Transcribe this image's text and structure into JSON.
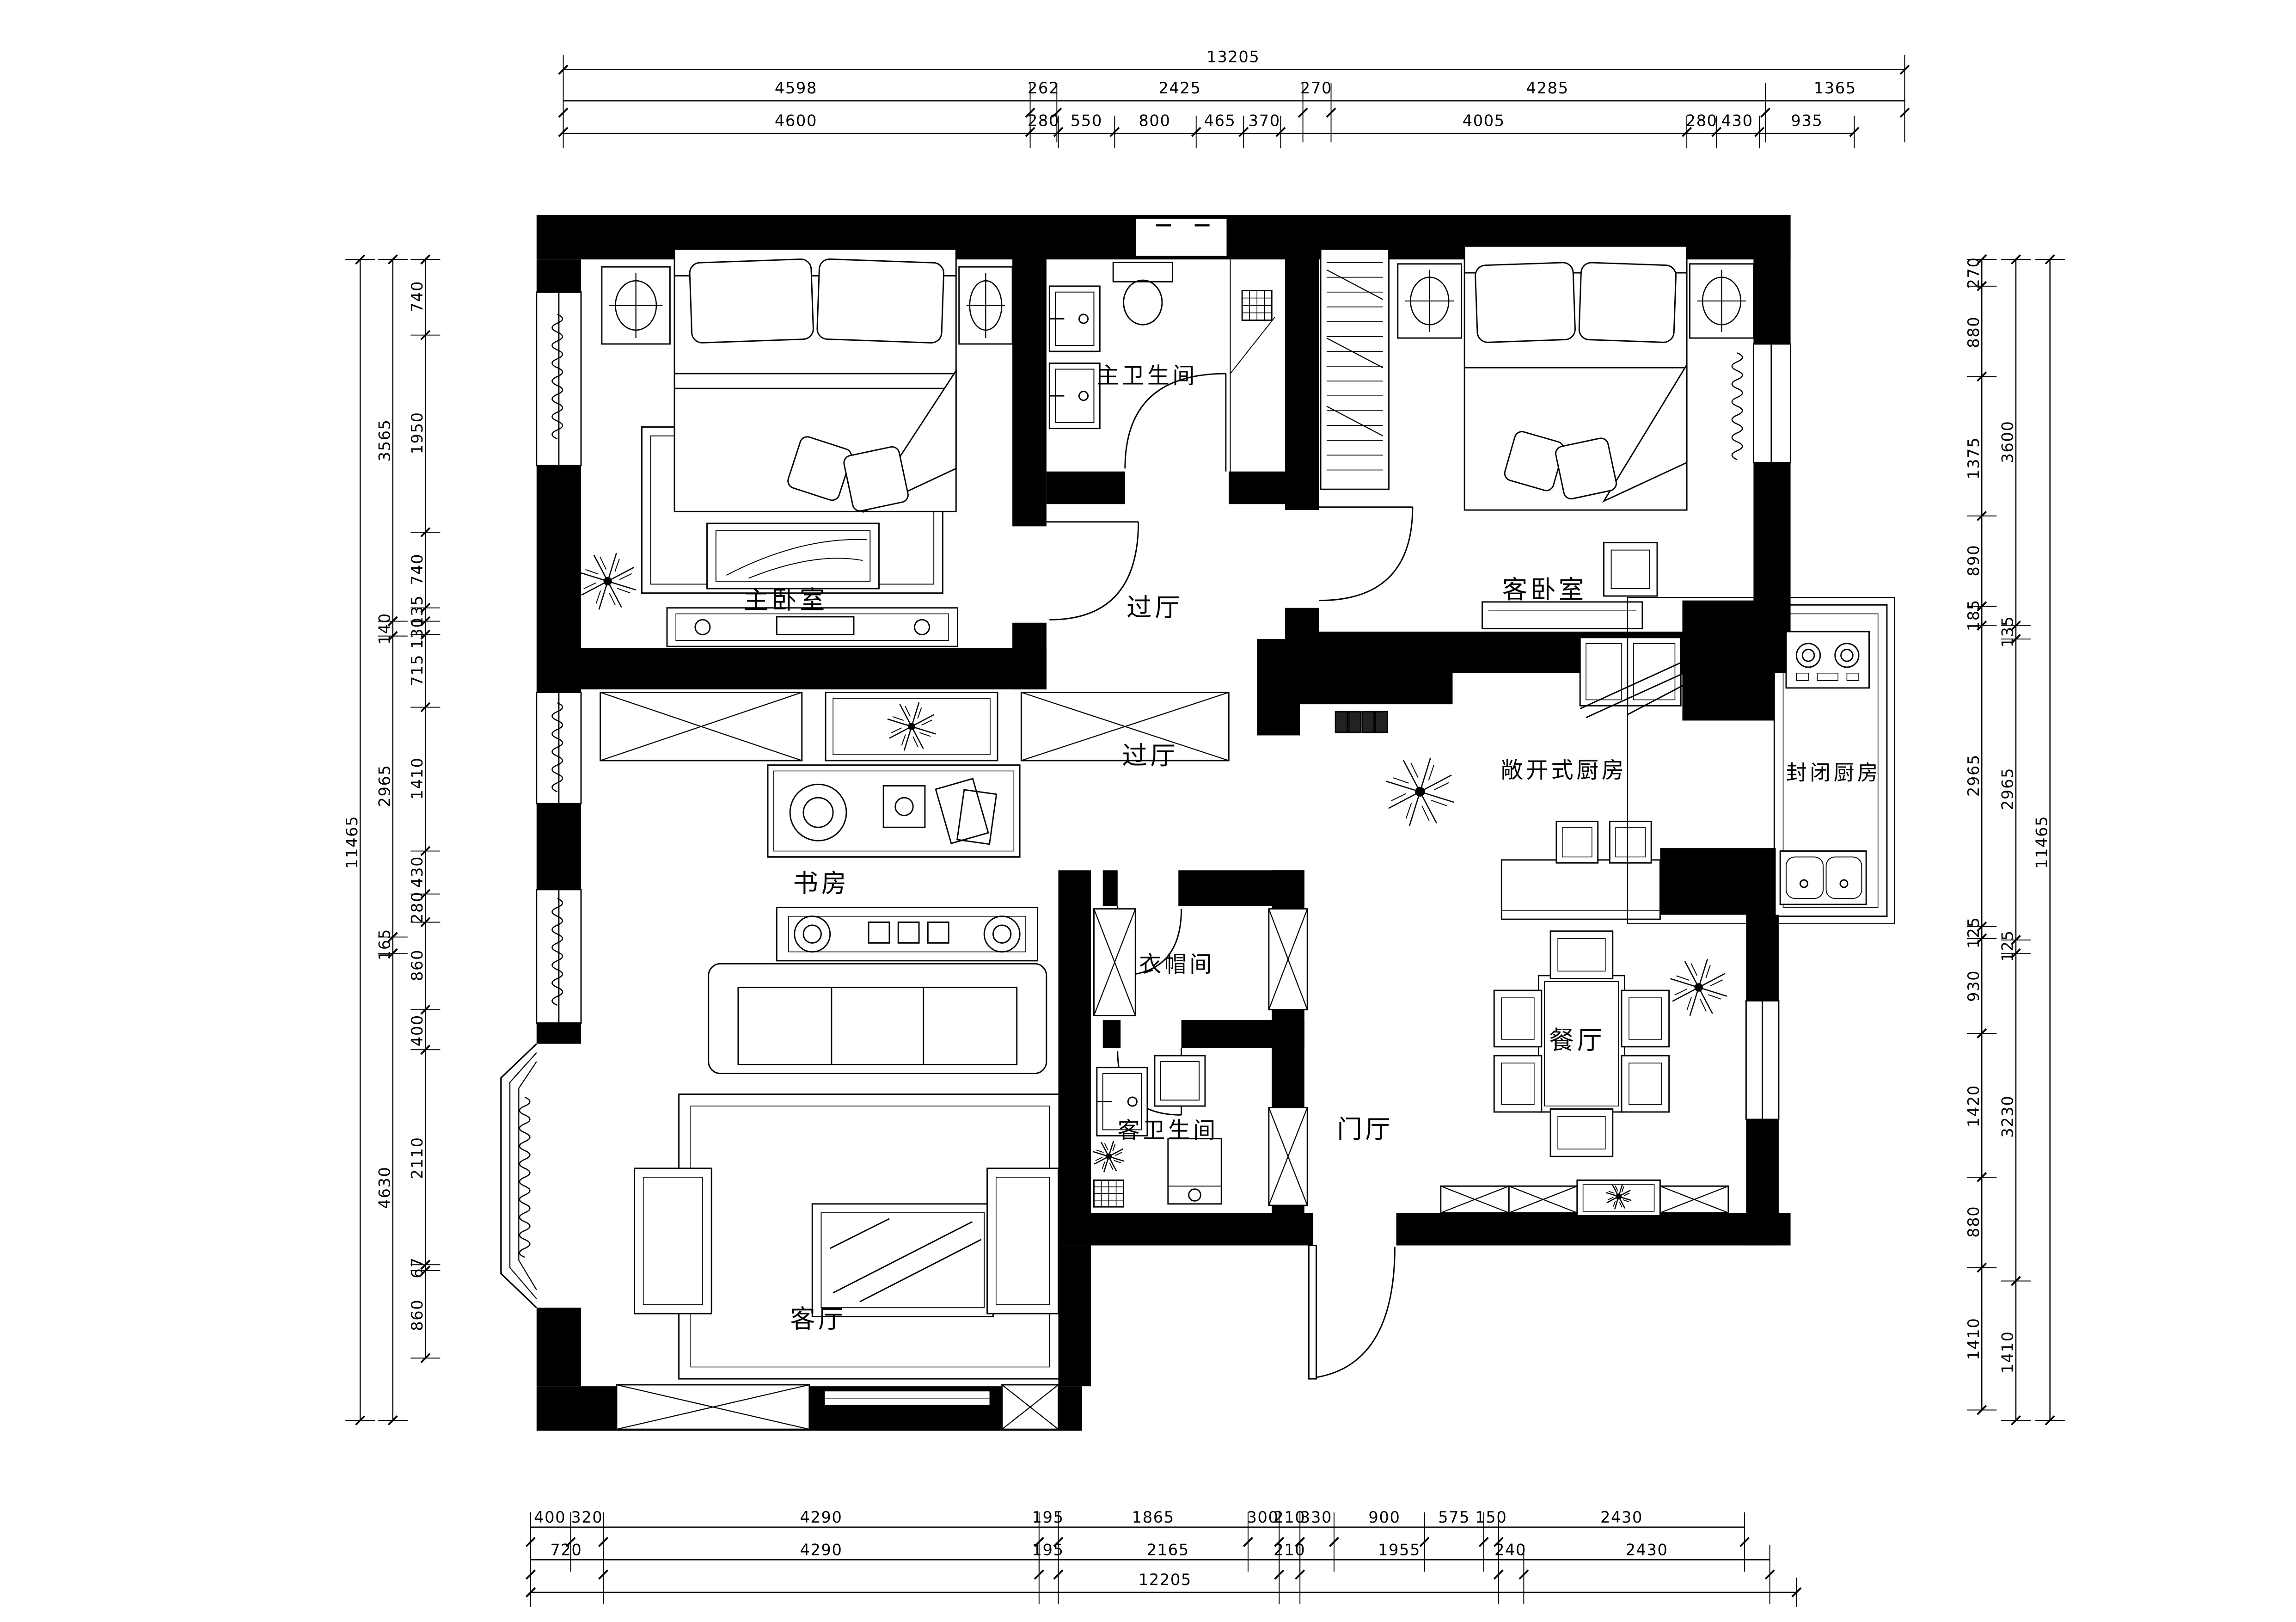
{
  "labels": {
    "master_bedroom": "主卧室",
    "master_bath": "主卫生间",
    "hall_upper": "过厅",
    "guest_bedroom": "客卧室",
    "hall_center": "过厅",
    "study": "书房",
    "open_kitchen": "敞开式厨房",
    "closed_kitchen": "封闭厨房",
    "cloakroom": "衣帽间",
    "guest_bath": "客卫生间",
    "foyer": "门厅",
    "dining": "餐厅",
    "living": "客厅"
  },
  "dims": {
    "top_total": "13205",
    "top_row2": [
      "4598",
      "262",
      "2425",
      "270",
      "4285",
      "1365"
    ],
    "top_row3": [
      "4600",
      "280",
      "550",
      "800",
      "465",
      "370",
      "4005",
      "280",
      "430",
      "935"
    ],
    "bottom_row1": [
      "400",
      "320",
      "4290",
      "195",
      "1865",
      "300",
      "210",
      "330",
      "900",
      "575",
      "150",
      "2430"
    ],
    "bottom_row2": [
      "720",
      "4290",
      "195",
      "2165",
      "210",
      "1955",
      "240",
      "2430"
    ],
    "bottom_total": "12205",
    "left_total": "11465",
    "left_mid": [
      "3565",
      "140",
      "2965",
      "165",
      "4630"
    ],
    "left_inner": [
      "740",
      "1950",
      "740",
      "135",
      "130",
      "715",
      "1410",
      "430",
      "280",
      "860",
      "400",
      "2110",
      "67",
      "860"
    ],
    "right_total": "11465",
    "right_mid": [
      "3600",
      "135",
      "2965",
      "125",
      "3230",
      "1410"
    ],
    "right_inner": [
      "270",
      "880",
      "1375",
      "890",
      "185",
      "2965",
      "125",
      "930",
      "1420",
      "880",
      "1410"
    ]
  }
}
